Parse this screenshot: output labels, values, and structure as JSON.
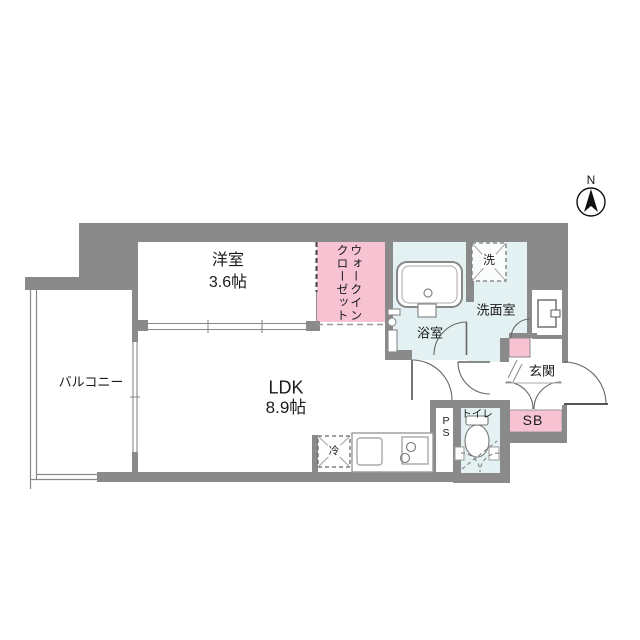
{
  "plan": {
    "compass": {
      "label": "N"
    },
    "rooms": {
      "bedroom": {
        "name": "洋室",
        "size": "3.6帖"
      },
      "ldk": {
        "name": "LDK",
        "size": "8.9帖"
      },
      "balcony": {
        "name": "バルコニー"
      },
      "walk_in_closet": {
        "line1": "ウォークイン",
        "line2": "クローゼット"
      },
      "bathroom": {
        "name": "浴室"
      },
      "laundry_pan": {
        "name": "洗"
      },
      "washroom": {
        "name": "洗面室"
      },
      "entrance": {
        "name": "玄関"
      },
      "shoe_box": {
        "name": "SB"
      },
      "toilet": {
        "name": "トイレ"
      },
      "pipe_space": {
        "line1": "P",
        "line2": "S"
      },
      "refrigerator": {
        "name": "冷"
      }
    },
    "colors": {
      "wall_gray": "#8a8a8a",
      "accent_pink": "#f7c3d2",
      "wet_area_blue": "#e4f1f3",
      "line_gray": "#888888"
    }
  }
}
